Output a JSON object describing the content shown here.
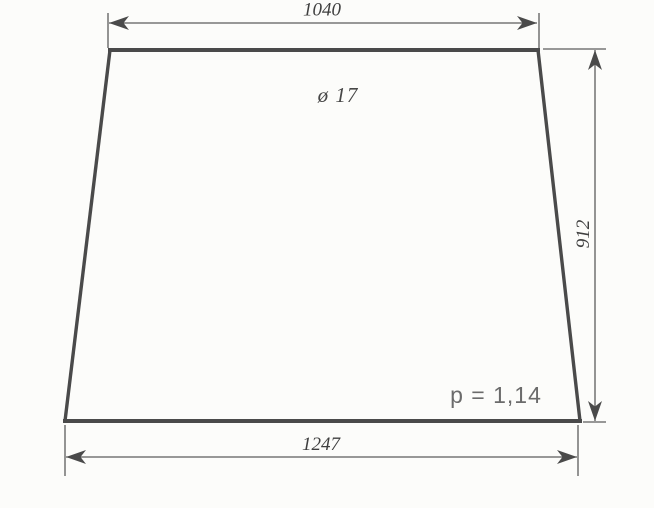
{
  "drawing": {
    "labels": {
      "top_width": "1040",
      "bottom_width": "1247",
      "right_height": "912",
      "hole": "ø 17",
      "p_value": "p = 1,14"
    },
    "colors": {
      "paper": "#fcfcfa",
      "outline_ink": "#4a4a4a",
      "thin_line": "#5c5c5c",
      "dimension_text": "#3f3f3f",
      "p_text": "#6b6b6b"
    }
  }
}
